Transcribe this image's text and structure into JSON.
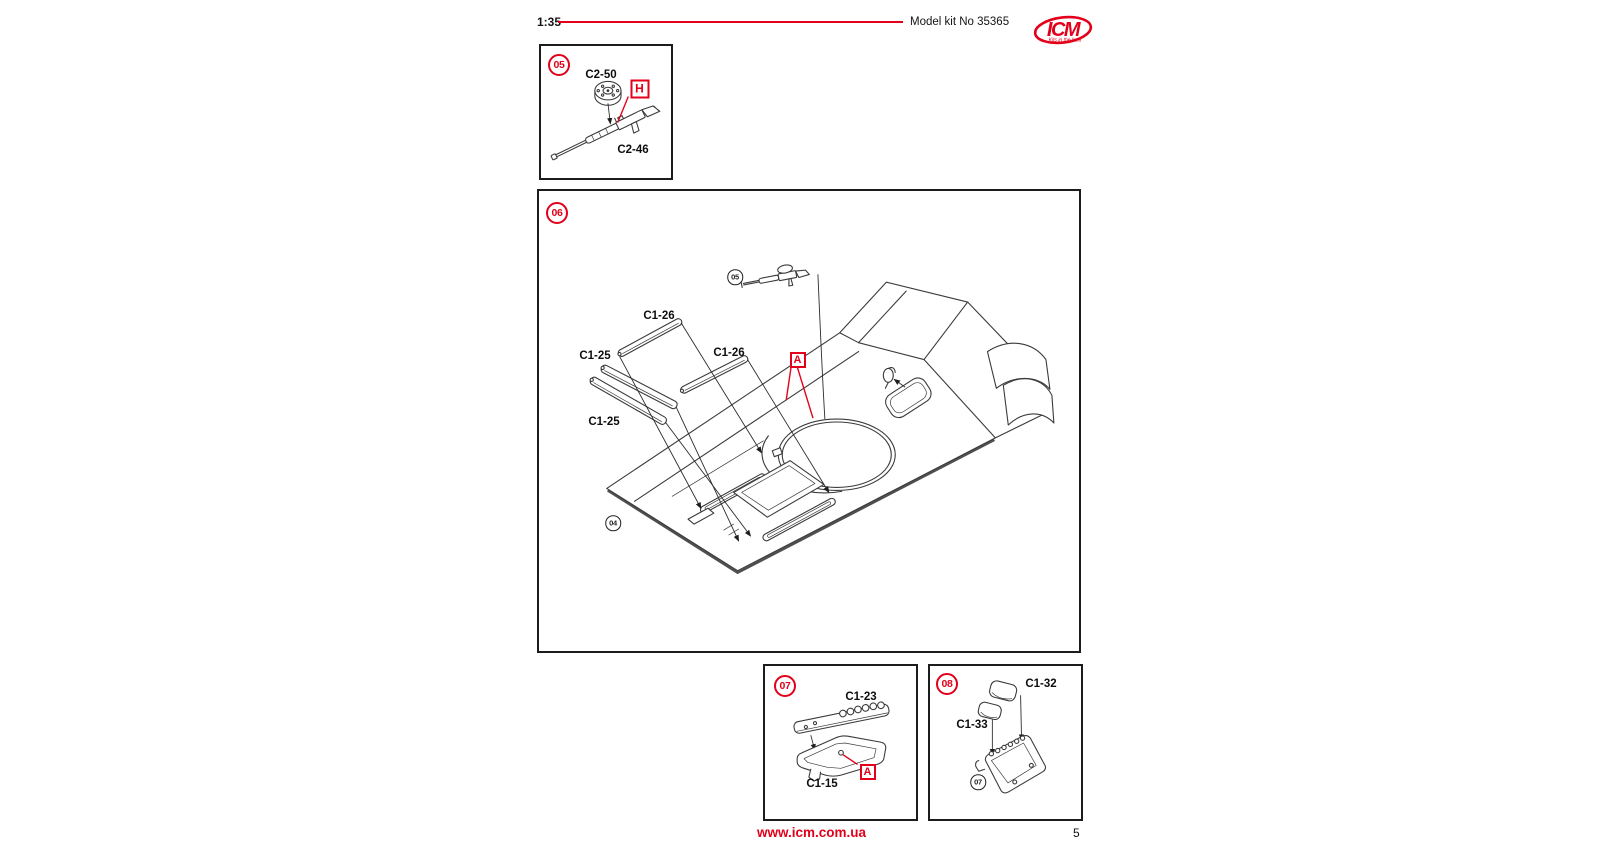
{
  "header": {
    "scale": "1:35",
    "kit_number": "Model kit No 35365"
  },
  "logo": {
    "text": "ICM",
    "tagline": "Kits in the best"
  },
  "footer": {
    "website": "www.icm.com.ua",
    "page_number": "5"
  },
  "colors": {
    "accent": "#e2001a",
    "ink": "#141414",
    "art_line": "#3a3a3a"
  },
  "steps": {
    "s05": {
      "number": "05",
      "marker": "H",
      "parts": {
        "drum": "C2-50",
        "gun": "C2-46"
      }
    },
    "s06": {
      "number": "06",
      "marker": "A",
      "ref_step_gun": "05",
      "ref_step_hull": "04",
      "parts": {
        "rail_top": "C1-26",
        "plate_left": "C1-25",
        "rail_right": "C1-26",
        "plate_bottom": "C1-25"
      }
    },
    "s07": {
      "number": "07",
      "marker": "A",
      "parts": {
        "tread_plate": "C1-23",
        "seat_pan": "C1-15"
      }
    },
    "s08": {
      "number": "08",
      "ref_step_seat": "07",
      "parts": {
        "cushion_back": "C1-32",
        "cushion_seat": "C1-33"
      }
    }
  }
}
